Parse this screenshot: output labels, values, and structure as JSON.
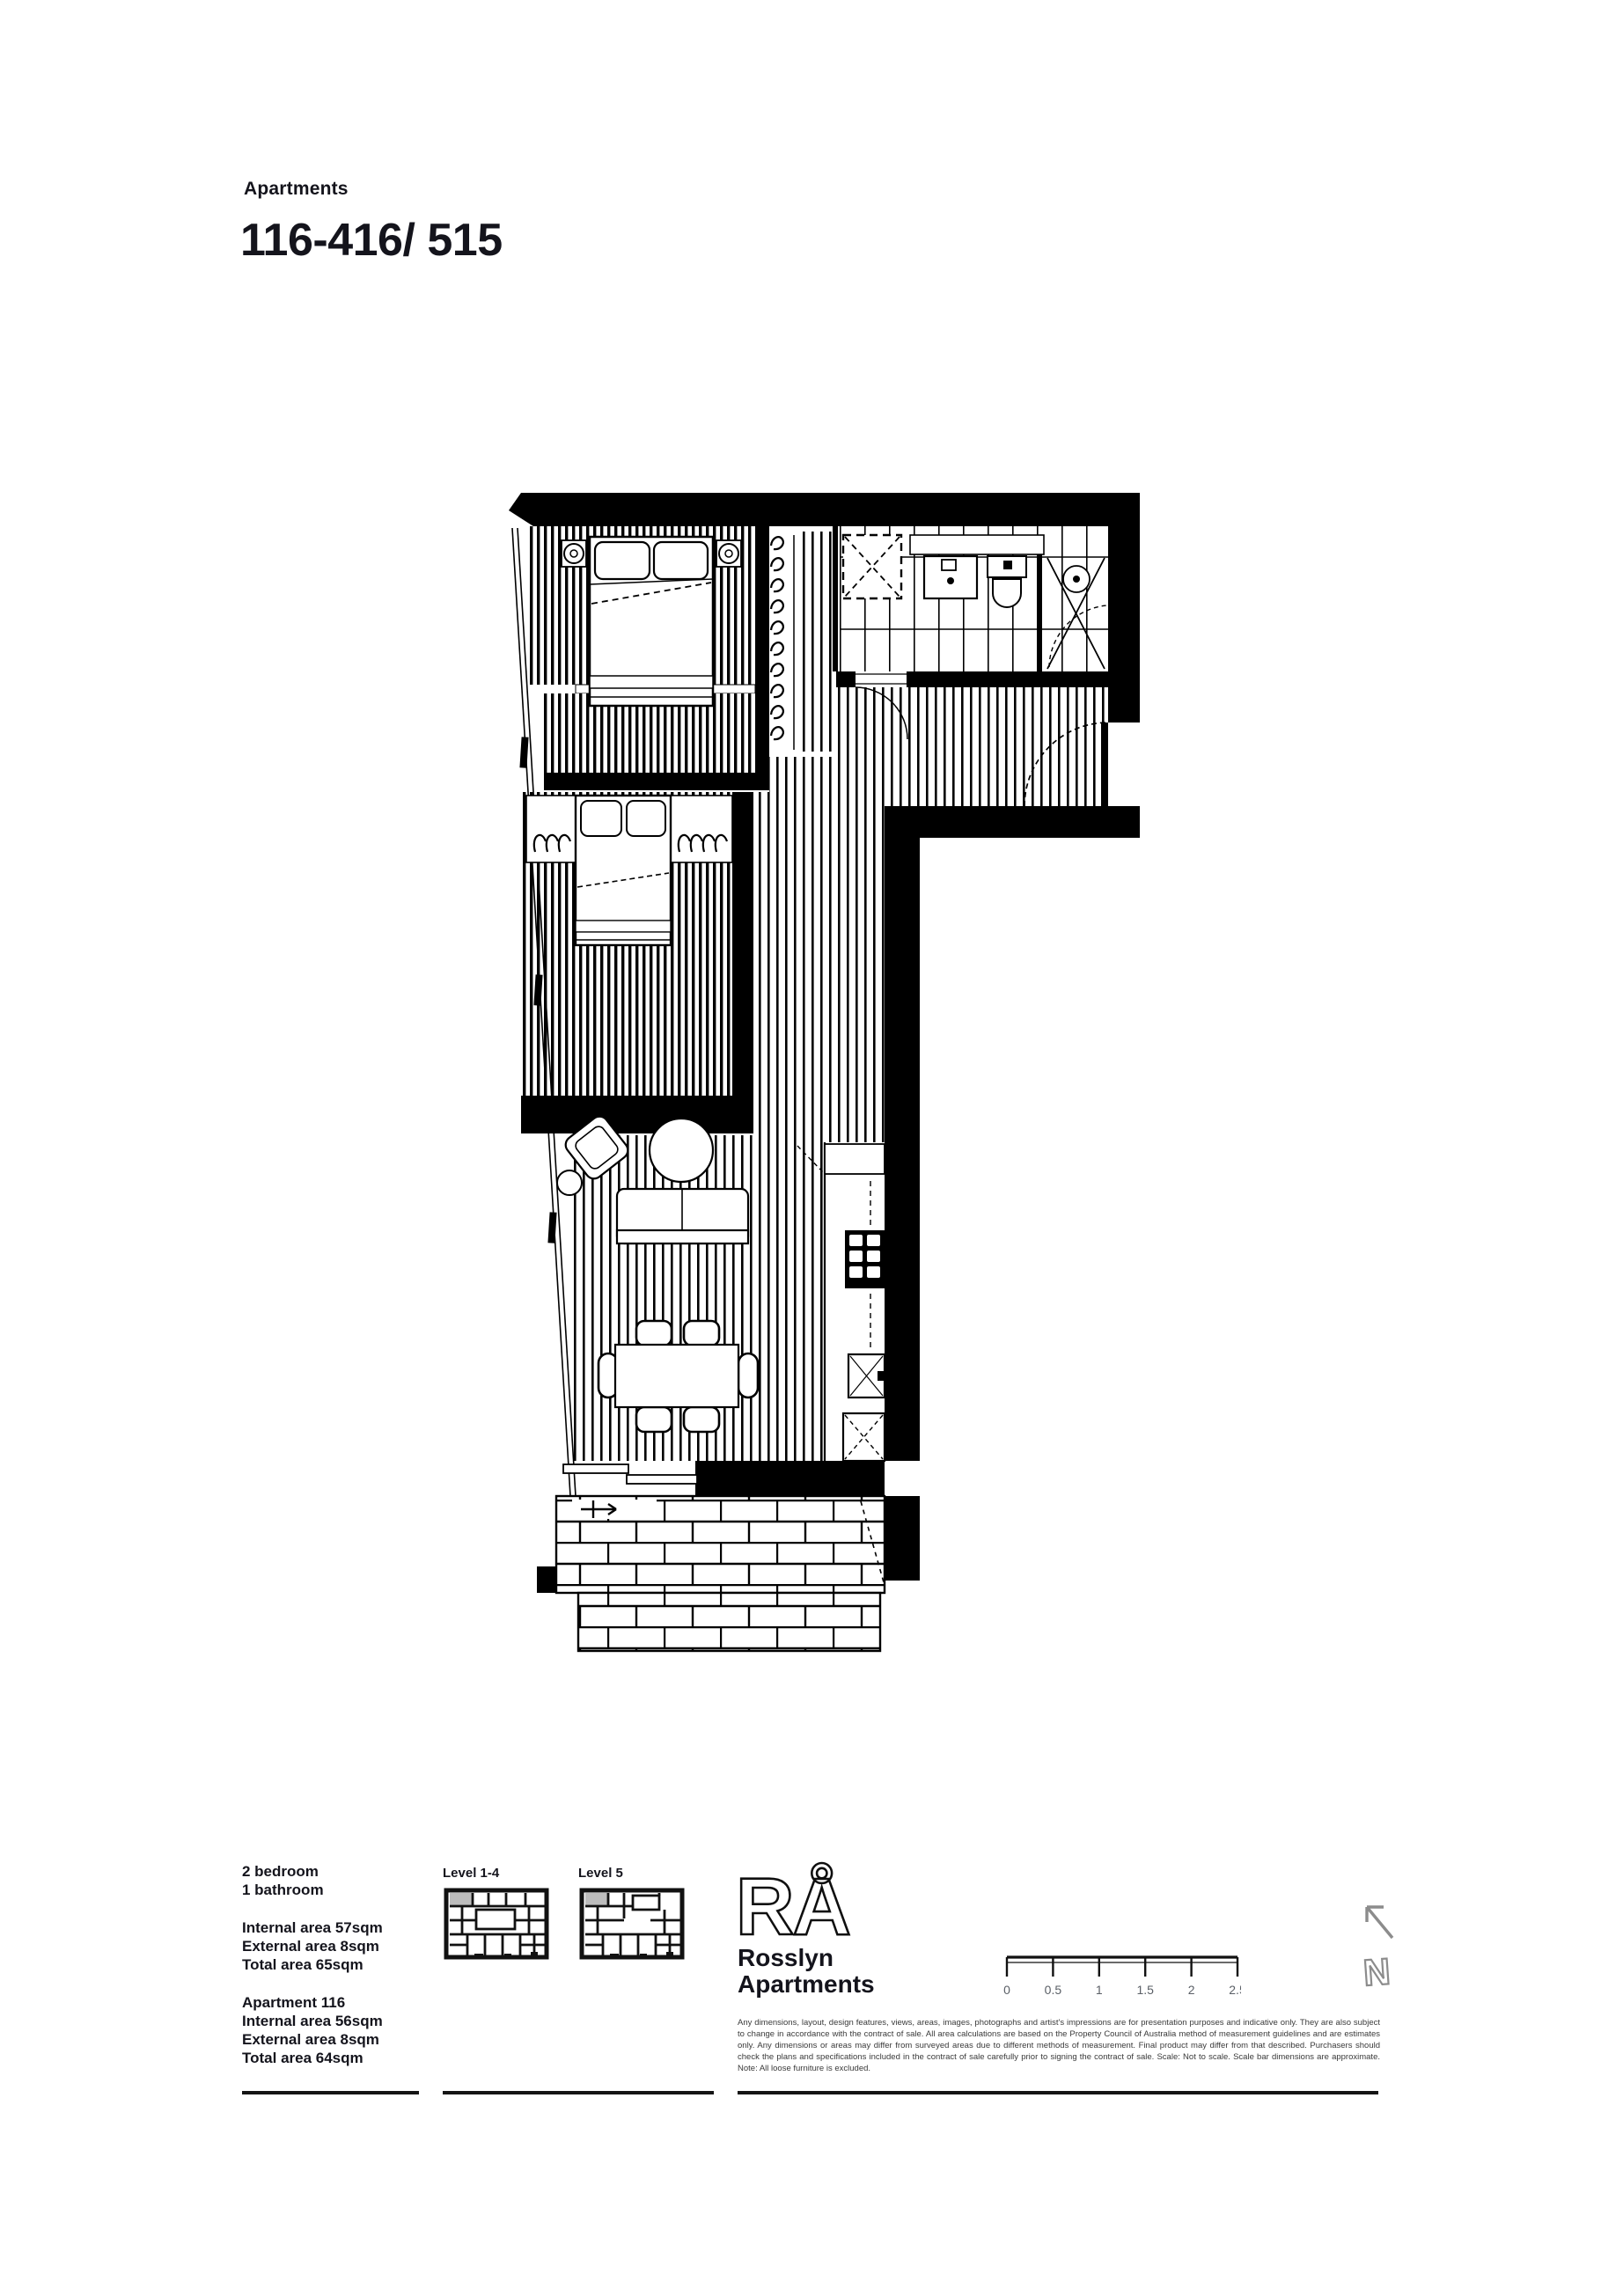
{
  "header": {
    "eyebrow": "Apartments",
    "title": "116-416/ 515"
  },
  "specs": {
    "bed": "2 bedroom",
    "bath": "1 bathroom",
    "internal": "Internal area 57sqm",
    "external": "External area 8sqm",
    "total": "Total area 65sqm",
    "apt": "Apartment 116",
    "apt_internal": "Internal area 56sqm",
    "apt_external": "External area 8sqm",
    "apt_total": "Total area 64sqm"
  },
  "levels": {
    "level14": "Level 1-4",
    "level5": "Level 5"
  },
  "brand": {
    "logo": "RÅ",
    "name1": "Rosslyn",
    "name2": "Apartments"
  },
  "scalebar": {
    "labels": [
      "0",
      "0.5",
      "1",
      "1.5",
      "2",
      "2.5"
    ]
  },
  "north": {
    "letter": "N"
  },
  "disclaimer": "Any dimensions, layout, design features, views, areas, images, photographs and artist's impressions are for presentation purposes and indicative only. They are also subject to change in accordance with the contract of sale. All area calculations are based on the Property Council of Australia method of measurement guidelines and are estimates only. Any dimensions or areas may differ from surveyed areas due to different methods of measurement. Final product may differ from that described. Purchasers should check the plans and specifications included in the contract of sale carefully prior to signing the contract of sale. Scale: Not to scale. Scale bar dimensions are approximate. Note: All loose furniture is excluded.",
  "colors": {
    "ink": "#111111",
    "gray": "#8c8c8c",
    "highlight": "#bdbdbd"
  }
}
